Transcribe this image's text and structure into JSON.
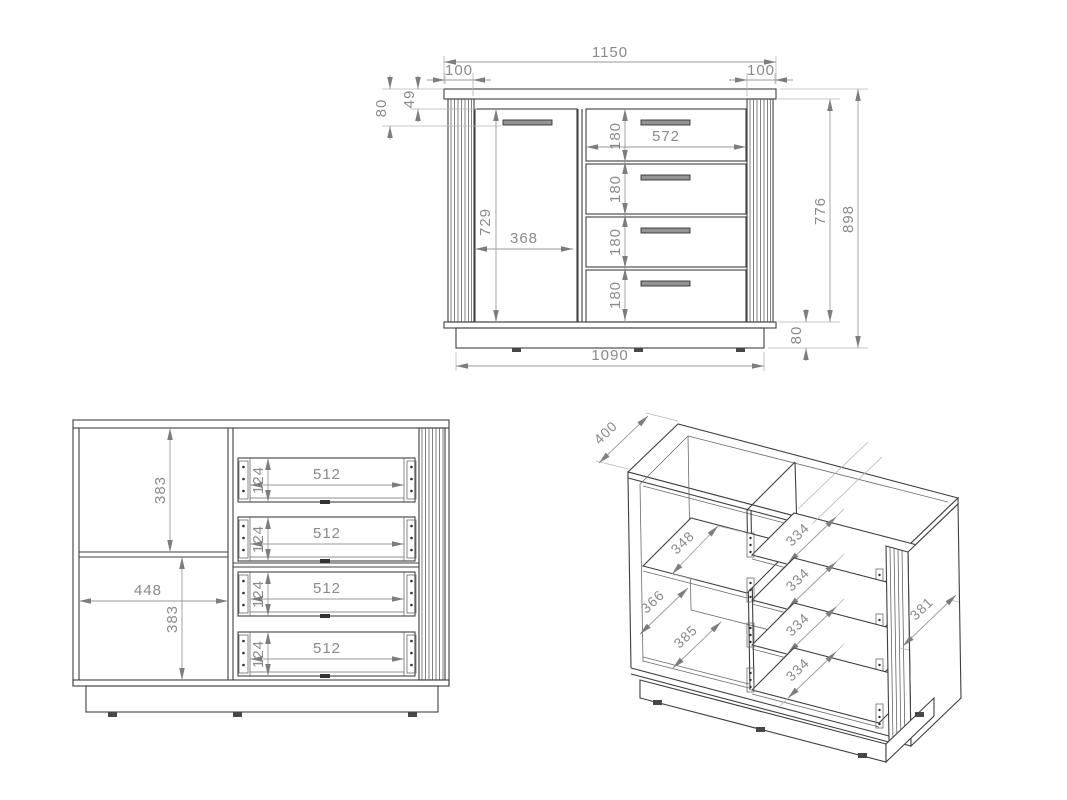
{
  "front_view": {
    "total_width": "1150",
    "pilaster_left": "100",
    "pilaster_right": "100",
    "top_panel_offset": "49",
    "handle_offset": "80",
    "door_height": "729",
    "door_width": "368",
    "drawer_front_width": "572",
    "drawer_front_heights": [
      "180",
      "180",
      "180",
      "180"
    ],
    "body_height": "776",
    "total_height": "898",
    "plinth_height": "80",
    "plinth_width": "1090"
  },
  "internal_view": {
    "upper_section_height": "383",
    "lower_section_height": "383",
    "door_opening_width": "448",
    "drawer_heights": [
      "124",
      "124",
      "124",
      "124"
    ],
    "drawer_widths": [
      "512",
      "512",
      "512",
      "512"
    ]
  },
  "isometric_view": {
    "total_depth": "400",
    "shelf_depth": "348",
    "mid_depth": "366",
    "bottom_depth": "385",
    "drawer_depths": [
      "334",
      "334",
      "334",
      "334"
    ],
    "side_depth": "381"
  }
}
